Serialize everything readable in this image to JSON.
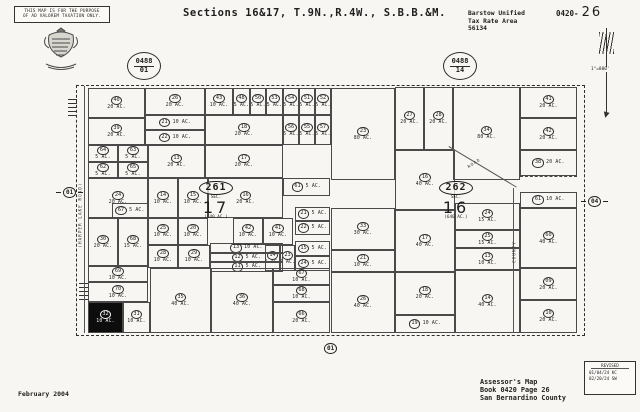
{
  "page": {
    "disclaimer_line1": "THIS MAP IS FOR THE PURPOSE",
    "disclaimer_line2": "OF AD VALOREM TAXATION ONLY.",
    "title": "Sections 16&17, T.9N.,R.4W., S.B.B.&M.",
    "tax_area": {
      "line1": "Barstow Unified",
      "line2": "Tax Rate Area",
      "line3": "56134"
    },
    "sheet_ref": {
      "prefix": "0420-",
      "page": "26"
    },
    "scale_label": "1\"=800'",
    "date": "February 2004",
    "footer": {
      "line1": "Assessor's Map",
      "line2": "Book 0420 Page 26",
      "line3": "San Bernardino County"
    },
    "revision": {
      "title": "REVISED",
      "entries": [
        "01/04/24 KC",
        "02/20/24 SW"
      ]
    }
  },
  "map": {
    "page_refs": [
      {
        "book": "0488",
        "page": "01"
      },
      {
        "book": "0488",
        "page": "14"
      }
    ],
    "section_labels": [
      {
        "assessor_block": "261",
        "sec": "SEC.",
        "section_number": "17",
        "acreage": "(640 AC.)"
      },
      {
        "assessor_block": "262",
        "sec": "SEC.",
        "section_number": "16",
        "acreage": "(640 AC.)"
      }
    ],
    "highway_markers": [
      "01",
      "04",
      "01"
    ],
    "roads": [
      {
        "name": "(HARPER LAKE ROAD)"
      },
      {
        "name": "COUNTY"
      },
      {
        "name": "ROAD"
      }
    ],
    "line_color": "#4a4a4a",
    "highlight_parcel_color": "#0d0d0d",
    "parcels": [
      {
        "num": "40",
        "ac": "20 AC.",
        "x": 88,
        "y": 88,
        "w": 57,
        "h": 30
      },
      {
        "num": "26",
        "ac": "20 AC.",
        "x": 145,
        "y": 88,
        "w": 60,
        "h": 27
      },
      {
        "num": "43",
        "ac": "10 AC.",
        "x": 205,
        "y": 88,
        "w": 28,
        "h": 27
      },
      {
        "num": "48",
        "ac": "5 AC.",
        "x": 233,
        "y": 88,
        "w": 17,
        "h": 27
      },
      {
        "num": "50",
        "ac": "5 AC.",
        "x": 250,
        "y": 88,
        "w": 16,
        "h": 27
      },
      {
        "num": "53",
        "ac": "5 AC.",
        "x": 266,
        "y": 88,
        "w": 17,
        "h": 27
      },
      {
        "num": "54",
        "ac": "5 AC.",
        "x": 283,
        "y": 88,
        "w": 16,
        "h": 27
      },
      {
        "num": "51",
        "ac": "5 AC.",
        "x": 299,
        "y": 88,
        "w": 16,
        "h": 27
      },
      {
        "num": "52",
        "ac": "5 AC.",
        "x": 315,
        "y": 88,
        "w": 16,
        "h": 27
      },
      {
        "num": "39",
        "ac": "20 AC.",
        "x": 88,
        "y": 118,
        "w": 57,
        "h": 27
      },
      {
        "num": "21",
        "ac": "10 AC.",
        "x": 145,
        "y": 115,
        "w": 60,
        "h": 15,
        "layout": "inline"
      },
      {
        "num": "22",
        "ac": "10 AC.",
        "x": 145,
        "y": 130,
        "w": 60,
        "h": 15,
        "layout": "inline"
      },
      {
        "num": "18",
        "ac": "20 AC.",
        "x": 205,
        "y": 115,
        "w": 78,
        "h": 30
      },
      {
        "num": "56",
        "ac": "5 AC.",
        "x": 283,
        "y": 115,
        "w": 16,
        "h": 30
      },
      {
        "num": "55",
        "ac": "5 AC.",
        "x": 299,
        "y": 115,
        "w": 16,
        "h": 30
      },
      {
        "num": "57",
        "ac": "5 AC.",
        "x": 315,
        "y": 115,
        "w": 16,
        "h": 30
      },
      {
        "num": "64",
        "ac": "5 AC.",
        "x": 88,
        "y": 145,
        "w": 30,
        "h": 17
      },
      {
        "num": "63",
        "ac": "5 AC.",
        "x": 118,
        "y": 145,
        "w": 30,
        "h": 17
      },
      {
        "num": "62",
        "ac": "5 AC.",
        "x": 88,
        "y": 162,
        "w": 30,
        "h": 16
      },
      {
        "num": "65",
        "ac": "5 AC.",
        "x": 118,
        "y": 162,
        "w": 30,
        "h": 16
      },
      {
        "num": "13",
        "ac": "20 AC.",
        "x": 148,
        "y": 145,
        "w": 57,
        "h": 33
      },
      {
        "num": "17",
        "ac": "20 AC.",
        "x": 205,
        "y": 145,
        "w": 78,
        "h": 33
      },
      {
        "num": "24",
        "ac": "20 AC.",
        "x": 88,
        "y": 178,
        "w": 60,
        "h": 40
      },
      {
        "num": "14",
        "ac": "10 AC.",
        "x": 148,
        "y": 178,
        "w": 30,
        "h": 40
      },
      {
        "num": "15",
        "ac": "10 AC.",
        "x": 178,
        "y": 178,
        "w": 30,
        "h": 40
      },
      {
        "num": "16",
        "ac": "20 AC.",
        "x": 208,
        "y": 178,
        "w": 75,
        "h": 40
      },
      {
        "num": "61",
        "ac": "5 AC.",
        "x": 283,
        "y": 178,
        "w": 47,
        "h": 18,
        "layout": "inline"
      },
      {
        "num": "67",
        "ac": "5 AC.",
        "x": 112,
        "y": 203,
        "w": 36,
        "h": 15,
        "layout": "inline"
      },
      {
        "num": "30",
        "ac": "20 AC.",
        "x": 88,
        "y": 218,
        "w": 30,
        "h": 48
      },
      {
        "num": "68",
        "ac": "15 AC.",
        "x": 118,
        "y": 218,
        "w": 30,
        "h": 48
      },
      {
        "num": "25",
        "ac": "10 AC.",
        "x": 148,
        "y": 218,
        "w": 30,
        "h": 27
      },
      {
        "num": "20",
        "ac": "10 AC.",
        "x": 178,
        "y": 218,
        "w": 30,
        "h": 27
      },
      {
        "num": "42",
        "ac": "10 AC.",
        "x": 233,
        "y": 218,
        "w": 30,
        "h": 27
      },
      {
        "num": "41",
        "ac": "10 AC.",
        "x": 263,
        "y": 218,
        "w": 30,
        "h": 27
      },
      {
        "num": "21",
        "ac": "5 AC.",
        "x": 295,
        "y": 207,
        "w": 35,
        "h": 14,
        "layout": "inline"
      },
      {
        "num": "22",
        "ac": "5 AC.",
        "x": 295,
        "y": 221,
        "w": 35,
        "h": 14,
        "layout": "inline"
      },
      {
        "num": "15",
        "ac": "5 AC.",
        "x": 295,
        "y": 241,
        "w": 35,
        "h": 15,
        "layout": "inline"
      },
      {
        "num": "24",
        "ac": "5 AC.",
        "x": 295,
        "y": 256,
        "w": 35,
        "h": 15,
        "layout": "inline"
      },
      {
        "num": "14",
        "ac": "5 AC.",
        "x": 265,
        "y": 245,
        "w": 15,
        "h": 26
      },
      {
        "num": "23",
        "ac": "5 AC.",
        "x": 280,
        "y": 245,
        "w": 15,
        "h": 26
      },
      {
        "num": "28",
        "ac": "10 AC.",
        "x": 148,
        "y": 245,
        "w": 30,
        "h": 23
      },
      {
        "num": "29",
        "ac": "10 AC.",
        "x": 178,
        "y": 245,
        "w": 32,
        "h": 23
      },
      {
        "num": "13",
        "ac": "10 AC.",
        "x": 210,
        "y": 243,
        "w": 73,
        "h": 10,
        "layout": "inline"
      },
      {
        "num": "12",
        "ac": "5 AC.",
        "x": 210,
        "y": 253,
        "w": 73,
        "h": 9,
        "layout": "inline"
      },
      {
        "num": "11",
        "ac": "5 AC.",
        "x": 210,
        "y": 262,
        "w": 73,
        "h": 10,
        "layout": "inline"
      },
      {
        "num": "69",
        "ac": "10 AC.",
        "x": 88,
        "y": 266,
        "w": 60,
        "h": 16
      },
      {
        "num": "70",
        "ac": "10 AC.",
        "x": 88,
        "y": 282,
        "w": 60,
        "h": 20
      },
      {
        "num": "32",
        "ac": "10 AC.",
        "x": 88,
        "y": 302,
        "w": 35,
        "h": 31,
        "fill": "black"
      },
      {
        "num": "31",
        "ac": "10 AC.",
        "x": 123,
        "y": 302,
        "w": 27,
        "h": 31
      },
      {
        "num": "35",
        "ac": "40 AC.",
        "x": 150,
        "y": 268,
        "w": 61,
        "h": 65
      },
      {
        "num": "36",
        "ac": "40 AC.",
        "x": 211,
        "y": 268,
        "w": 62,
        "h": 65
      },
      {
        "num": "67",
        "ac": "10 AC.",
        "x": 273,
        "y": 268,
        "w": 57,
        "h": 17
      },
      {
        "num": "68",
        "ac": "10 AC.",
        "x": 273,
        "y": 285,
        "w": 57,
        "h": 17
      },
      {
        "num": "66",
        "ac": "20 AC.",
        "x": 273,
        "y": 302,
        "w": 57,
        "h": 31
      },
      {
        "num": "23",
        "ac": "80 AC.",
        "x": 331,
        "y": 88,
        "w": 64,
        "h": 92
      },
      {
        "num": "27",
        "ac": "20 AC.",
        "x": 395,
        "y": 87,
        "w": 29,
        "h": 63
      },
      {
        "num": "28",
        "ac": "20 AC.",
        "x": 424,
        "y": 87,
        "w": 29,
        "h": 63
      },
      {
        "num": "34",
        "ac": "80 AC.",
        "x": 453,
        "y": 87,
        "w": 67,
        "h": 93
      },
      {
        "num": "41",
        "ac": "20 AC.",
        "x": 520,
        "y": 87,
        "w": 57,
        "h": 31
      },
      {
        "num": "42",
        "ac": "20 AC.",
        "x": 520,
        "y": 118,
        "w": 57,
        "h": 32
      },
      {
        "num": "38",
        "ac": "20 AC.",
        "x": 520,
        "y": 150,
        "w": 57,
        "h": 26,
        "layout": "inline"
      },
      {
        "num": "61",
        "ac": "10 AC.",
        "x": 520,
        "y": 192,
        "w": 57,
        "h": 16,
        "layout": "inline"
      },
      {
        "num": "60",
        "ac": "40 AC.",
        "x": 520,
        "y": 208,
        "w": 57,
        "h": 60
      },
      {
        "num": "09",
        "ac": "20 AC.",
        "x": 520,
        "y": 268,
        "w": 57,
        "h": 32
      },
      {
        "num": "10",
        "ac": "20 AC.",
        "x": 520,
        "y": 300,
        "w": 57,
        "h": 33
      },
      {
        "num": "16",
        "ac": "40 AC.",
        "x": 395,
        "y": 150,
        "w": 60,
        "h": 60
      },
      {
        "num": "17",
        "ac": "40 AC.",
        "x": 395,
        "y": 210,
        "w": 60,
        "h": 62
      },
      {
        "num": "24",
        "ac": "15 AC.",
        "x": 455,
        "y": 203,
        "w": 65,
        "h": 27
      },
      {
        "num": "25",
        "ac": "15 AC.",
        "x": 455,
        "y": 230,
        "w": 65,
        "h": 18
      },
      {
        "num": "13",
        "ac": "10 AC.",
        "x": 455,
        "y": 248,
        "w": 65,
        "h": 22
      },
      {
        "num": "14",
        "ac": "40 AC.",
        "x": 455,
        "y": 270,
        "w": 65,
        "h": 63
      },
      {
        "num": "33",
        "ac": "30 AC.",
        "x": 331,
        "y": 208,
        "w": 64,
        "h": 42
      },
      {
        "num": "21",
        "ac": "10 AC.",
        "x": 331,
        "y": 250,
        "w": 64,
        "h": 22
      },
      {
        "num": "26",
        "ac": "40 AC.",
        "x": 331,
        "y": 272,
        "w": 64,
        "h": 61
      },
      {
        "num": "18",
        "ac": "20 AC.",
        "x": 395,
        "y": 272,
        "w": 60,
        "h": 43
      },
      {
        "num": "19",
        "ac": "10 AC.",
        "x": 395,
        "y": 315,
        "w": 60,
        "h": 18,
        "layout": "inline"
      }
    ]
  }
}
